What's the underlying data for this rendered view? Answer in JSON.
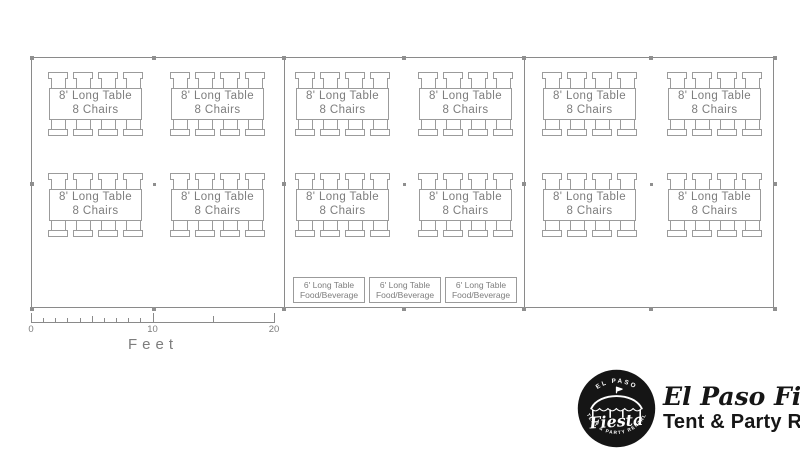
{
  "tent": {
    "sections": 3,
    "guest_table_count": 12,
    "food_table_count": 3,
    "guest_table_label": {
      "line1": "8' Long Table",
      "line2": "8 Chairs"
    },
    "food_table_label": {
      "line1": "6' Long Table",
      "line2": "Food/Beverage"
    },
    "colors": {
      "line": "#8a8a8a",
      "table_line": "#9b9b9b",
      "text": "#7d7d7d"
    }
  },
  "scale": {
    "unit_label": "Feet",
    "tick_labels": [
      "0",
      "10",
      "20"
    ],
    "ticks": [
      {
        "ft": 0,
        "h": 9,
        "label": "0"
      },
      {
        "ft": 1,
        "h": 4
      },
      {
        "ft": 2,
        "h": 4
      },
      {
        "ft": 3,
        "h": 4
      },
      {
        "ft": 4,
        "h": 4
      },
      {
        "ft": 5,
        "h": 6
      },
      {
        "ft": 6,
        "h": 4
      },
      {
        "ft": 7,
        "h": 4
      },
      {
        "ft": 8,
        "h": 4
      },
      {
        "ft": 9,
        "h": 4
      },
      {
        "ft": 10,
        "h": 9,
        "label": "10"
      },
      {
        "ft": 15,
        "h": 6
      },
      {
        "ft": 20,
        "h": 9,
        "label": "20"
      }
    ]
  },
  "logo": {
    "badge": {
      "arc_top": "EL PASO",
      "script": "Fiesta",
      "arc_bottom": "TENT & PARTY RENTAL"
    },
    "brand": "El Paso Fiesta",
    "tagline": "Tent & Party Rental",
    "color": "#161616"
  }
}
